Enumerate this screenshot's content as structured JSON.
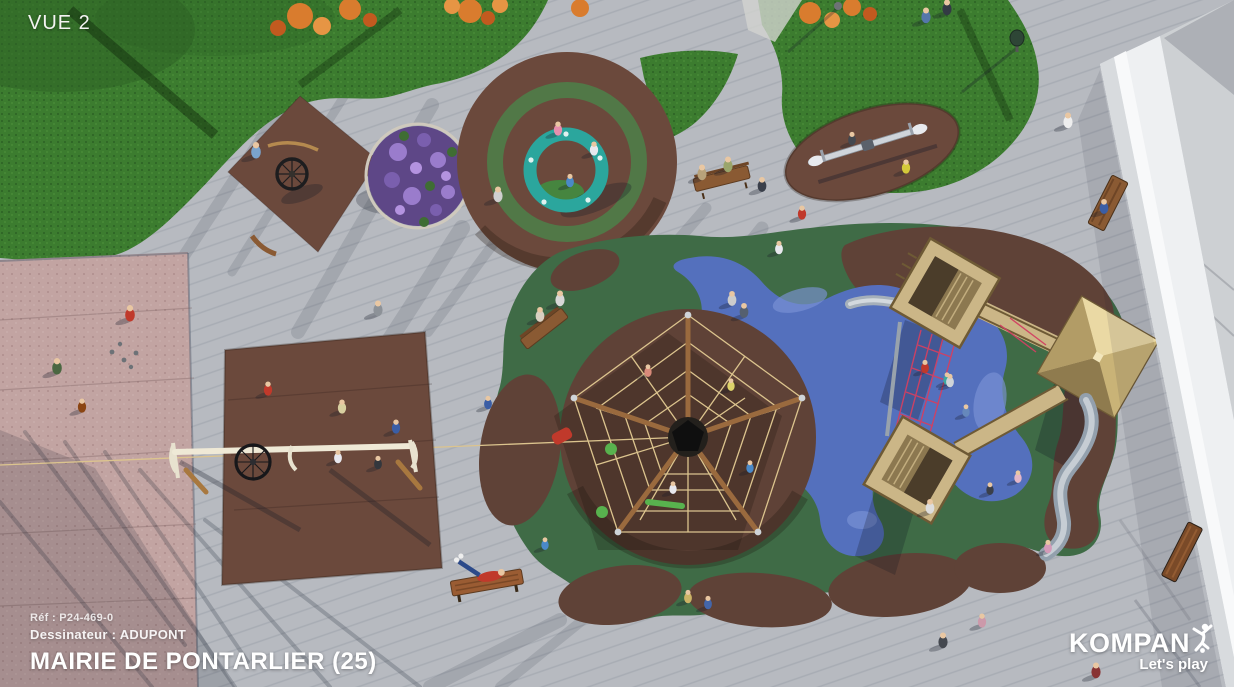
{
  "view_label": "VUE 2",
  "footer": {
    "reference": "Réf : P24-469-0",
    "designer": "Dessinateur : ADUPONT",
    "title": "MAIRIE DE PONTARLIER (25)"
  },
  "brand": {
    "name": "KOMPAN",
    "tagline": "Let's play"
  },
  "scene": {
    "description": "Aerial 3D render of a playground design on a paved plaza",
    "elements": [
      "grass-lawn",
      "petanque-court",
      "spinner-wheel",
      "flower-planter",
      "ring-carousel",
      "seesaw",
      "rope-pyramid-climber",
      "wooden-tower-structure",
      "wavy-slide",
      "multi-play-beam",
      "park-benches",
      "boundary-wall",
      "pedestrians"
    ],
    "colors": {
      "pavement": "#b7bac0",
      "pavement_far": "#cdd0d3",
      "grass": "#3c7c2f",
      "grass_dark": "#2c5f23",
      "rubber_brown": "#6b493c",
      "rubber_brown_dark": "#5f4237",
      "rubber_green": "#3f6b46",
      "rubber_blue": "#5571c4",
      "court_pink": "#c2a4a2",
      "wall_white": "#eef0f2",
      "carousel_teal": "#2ba69d",
      "ring_green": "#4f7d48",
      "wood": "#cbb687",
      "wood_dark": "#8a5a33",
      "rope": "#dcc48e",
      "net_red": "#d24062",
      "slide_gray": "#93a0ad"
    }
  }
}
